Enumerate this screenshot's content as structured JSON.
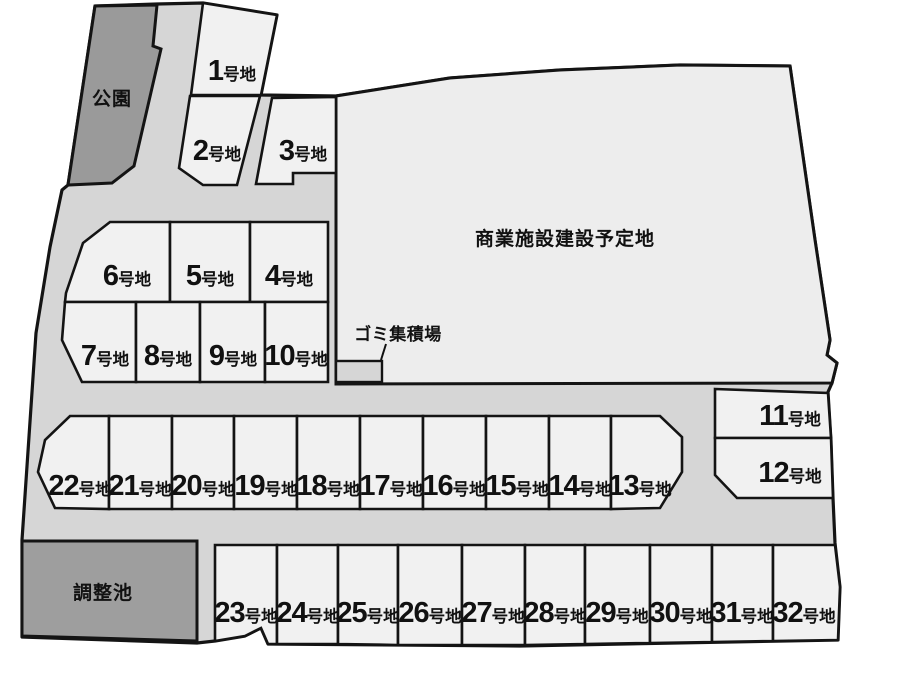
{
  "areas": {
    "park": {
      "label": "公園"
    },
    "commercial": {
      "label": "商業施設建設予定地"
    },
    "garbage": {
      "label": "ゴミ集積場"
    },
    "pond": {
      "label": "調整池"
    }
  },
  "lots": {
    "suffix": "号地",
    "numbers": [
      "1",
      "2",
      "3",
      "4",
      "5",
      "6",
      "7",
      "8",
      "9",
      "10",
      "11",
      "12",
      "13",
      "14",
      "15",
      "16",
      "17",
      "18",
      "19",
      "20",
      "21",
      "22",
      "23",
      "24",
      "25",
      "26",
      "27",
      "28",
      "29",
      "30",
      "31",
      "32"
    ]
  },
  "colors": {
    "background": "#ffffff",
    "road": "#d6d6d6",
    "lot": "#f1f1f1",
    "commercial": "#ededed",
    "park": "#9a9a9a",
    "pond": "#9e9e9e",
    "outline": "#141414",
    "text": "#111111"
  }
}
